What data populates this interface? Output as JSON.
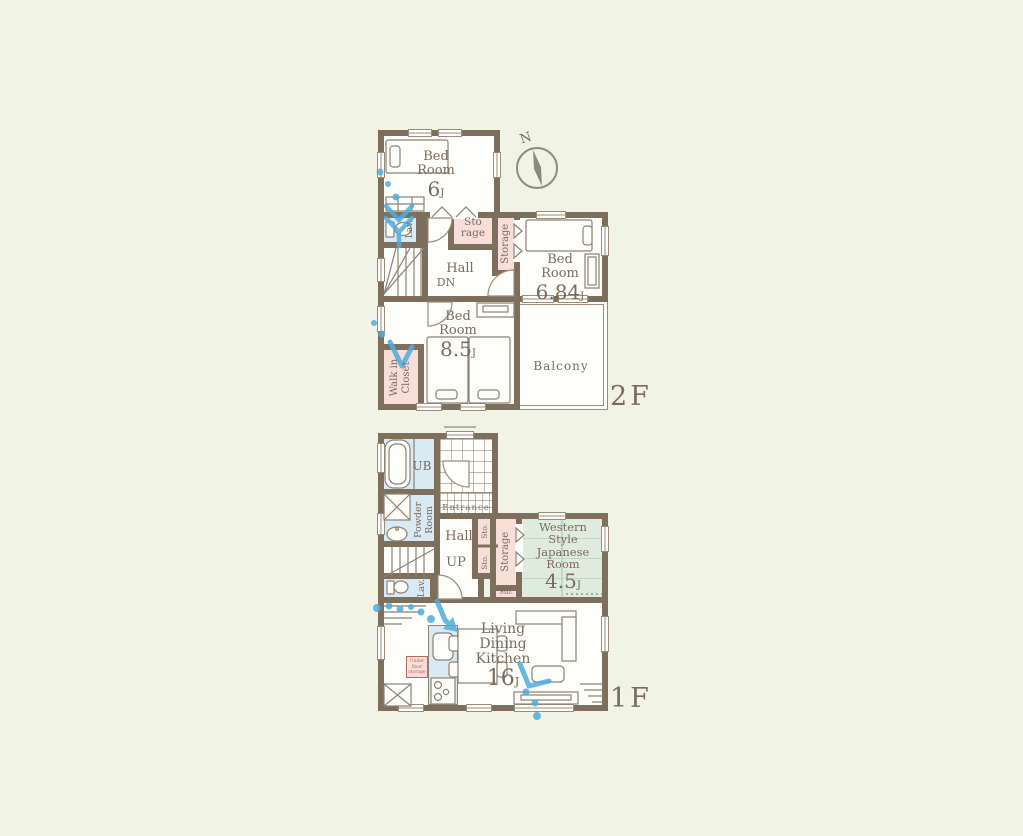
{
  "colors": {
    "background": "#F1F4E4",
    "wall": "#7E6F5D",
    "room_floor": "#FDFDFA",
    "water_room": "#D9EAF5",
    "closet_pink": "#F9DDD9",
    "tatami_green": "#DFEBDD",
    "line_art": "#8A8273",
    "text": "#7A6B5C",
    "annotation_blue": "#4FACDF"
  },
  "compass": {
    "label": "N"
  },
  "f2": {
    "tag": "2F",
    "br6": {
      "n1": "Bed",
      "n2": "Room",
      "size": "6",
      "unit": "J"
    },
    "br684": {
      "n1": "Bed",
      "n2": "Room",
      "size": "6.84",
      "unit": "J"
    },
    "br85": {
      "n1": "Bed",
      "n2": "Room",
      "size": "8.5",
      "unit": "J"
    },
    "lav": "Lav.",
    "hall": "Hall",
    "dn": "DN",
    "sto1": "Sto",
    "sto2": "rage",
    "storage": "Storage",
    "wic1": "Walk in",
    "wic2": "Closet",
    "balcony": "Balcony"
  },
  "f1": {
    "tag": "1F",
    "ub": "UB",
    "powder1": "Powder",
    "powder2": "Room",
    "entrance": "Entrance",
    "hall": "Hall",
    "up": "UP",
    "lav": "Lav.",
    "stoA": "Sto.",
    "stoB": "Sto.",
    "stoC": "Sto.",
    "storage": "Storage",
    "wsjr": {
      "n1": "Western",
      "n2": "Style",
      "n3": "Japanese",
      "n4": "Room",
      "size": "4.5",
      "unit": "J"
    },
    "ldk": {
      "n1": "Living",
      "n2": "Dining",
      "n3": "Kitchen",
      "size": "16",
      "unit": "J"
    },
    "ufs1": "Under",
    "ufs2": "floor",
    "ufs3": "storage"
  }
}
